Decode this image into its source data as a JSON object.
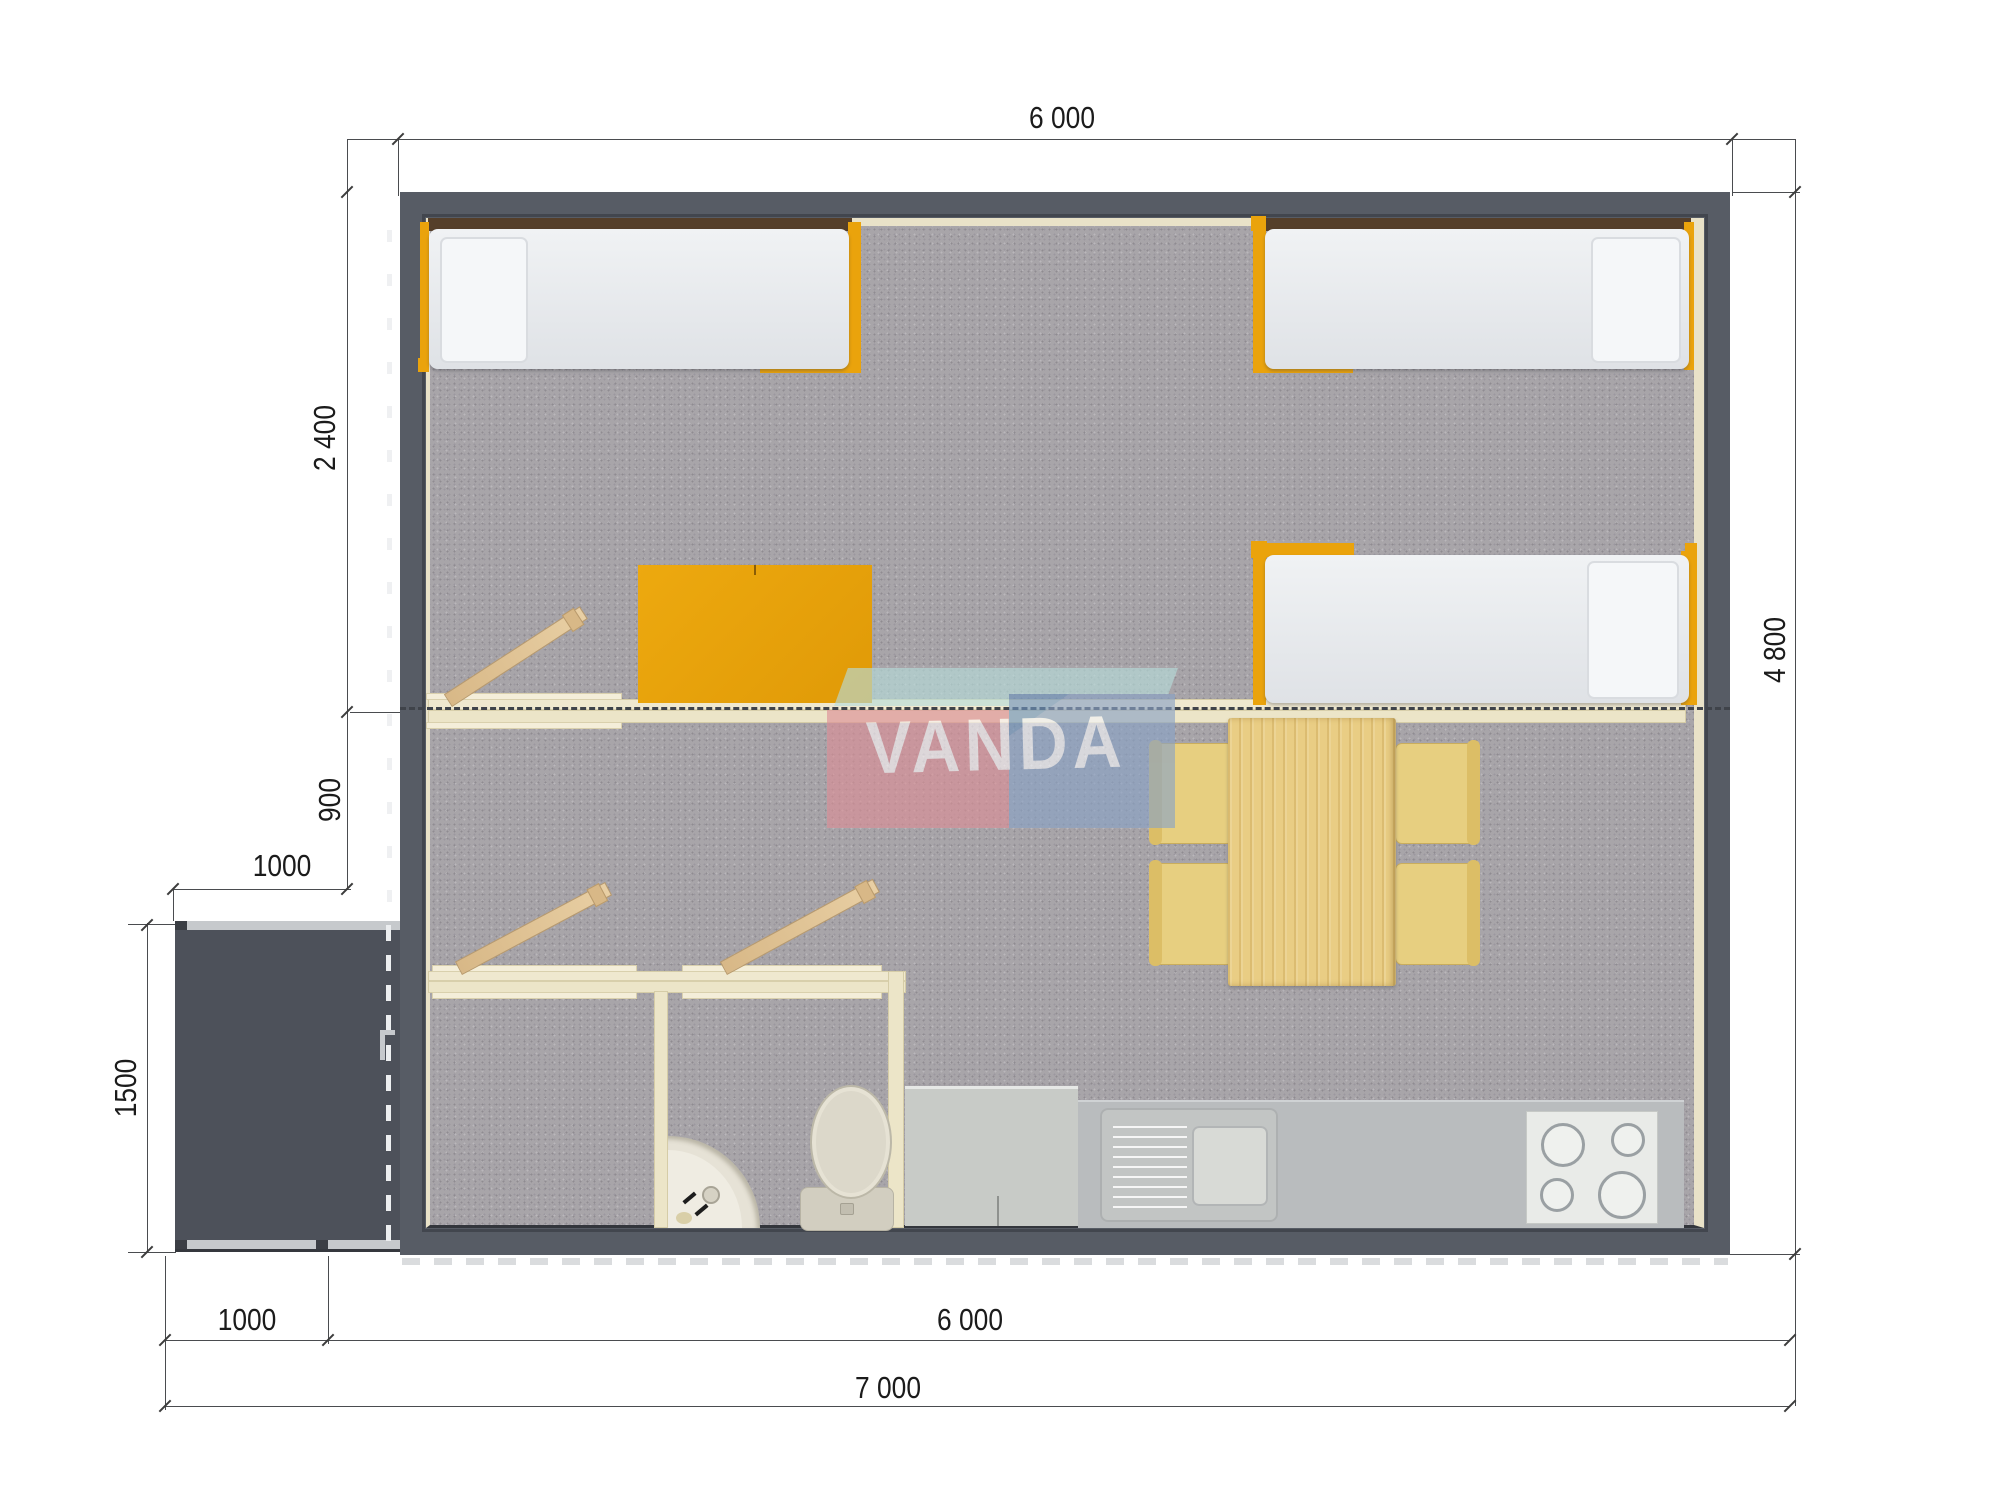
{
  "plan_title": "modular-house-floor-plan",
  "watermark": {
    "text": "VANDA",
    "colors": {
      "pink": "#dd8f97",
      "blue": "#8aa3c6",
      "teal_band": "#b7dcda",
      "text": "#ffffff"
    }
  },
  "dims": {
    "top_width": "6 000",
    "left_bed_zone_height": "2 400",
    "left_hall_zone_height": "900",
    "porch_width_upper": "1000",
    "porch_height": "1500",
    "right_total_height": "4 800",
    "bottom_porch_width": "1000",
    "bottom_house_width": "6 000",
    "bottom_total_width": "7 000"
  },
  "palette": {
    "wall_gray": "#575c65",
    "carpet_gray": "#a8a5a9",
    "interior_lining_cream": "#ece5c8",
    "accent_orange": "#eaa30c",
    "wood_light": "#e9cd84",
    "chair_yellow": "#e7cf80",
    "counter_gray": "#b9bcbe",
    "porch_gray": "#4d515a",
    "fixture_cream": "#dcd8ca"
  },
  "furniture_icons": [
    "single-bed",
    "single-bed",
    "single-bed",
    "wardrobe",
    "dining-table",
    "chair",
    "chair",
    "chair",
    "chair",
    "fridge",
    "kitchen-counter",
    "kitchen-sink",
    "stove-4-burners",
    "toilet",
    "corner-washbasin",
    "door-leaf",
    "door-leaf",
    "door-leaf",
    "entry-door",
    "porch-deck",
    "module-joint-dashed-line"
  ]
}
